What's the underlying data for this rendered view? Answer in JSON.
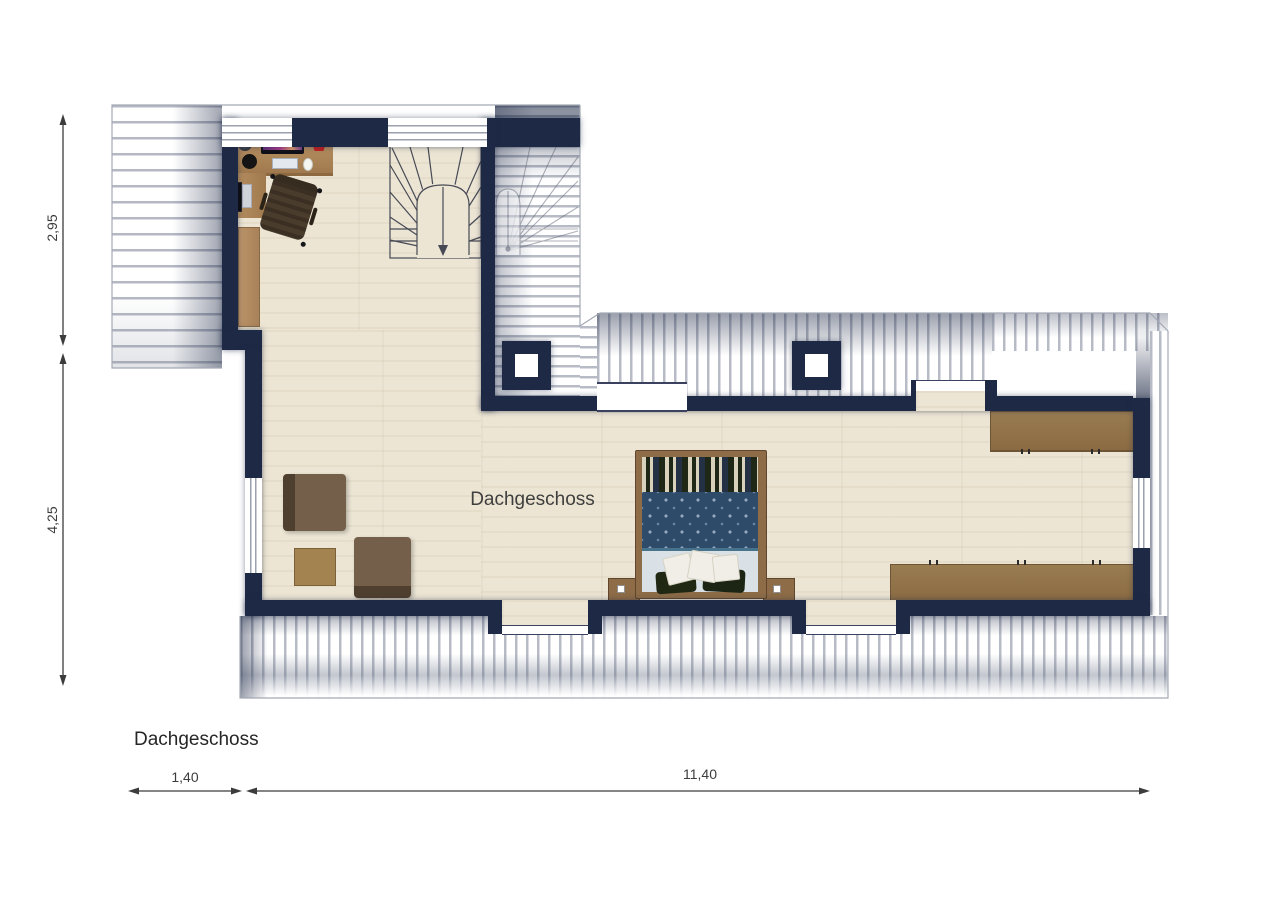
{
  "labels": {
    "room": "Dachgeschoss",
    "title": "Dachgeschoss",
    "dim_v1": "2,95",
    "dim_v2": "4,25",
    "dim_h1": "1,40",
    "dim_h2": "11,40"
  },
  "plan": {
    "floor_name": "Dachgeschoss",
    "dimensions_m": {
      "left_upper": "2,95",
      "left_lower": "4,25",
      "bottom_left": "1,40",
      "bottom_right": "11,40"
    },
    "elements": [
      "roof-hatch",
      "staircase",
      "ghost-staircase",
      "desk",
      "desk-monitor",
      "keyboard",
      "mouse",
      "office-chair",
      "cabinet",
      "armchair",
      "armchair",
      "side-table",
      "double-bed",
      "nightstand",
      "nightstand",
      "wardrobe-top",
      "wardrobe-bottom",
      "chimney-pillar",
      "chimney-pillar",
      "dormer-window",
      "dormer-window",
      "dormer-window",
      "window-left",
      "window-right",
      "roof-window-top-1",
      "roof-window-top-2"
    ],
    "colors": {
      "wall": "#1e2945",
      "floor": "#ece5d4",
      "wood": "#8d6c47",
      "hatch_stripe": "#b7bbc6",
      "bed_duvet": "#2e4b69",
      "dimension": "#3c3c3c"
    }
  }
}
